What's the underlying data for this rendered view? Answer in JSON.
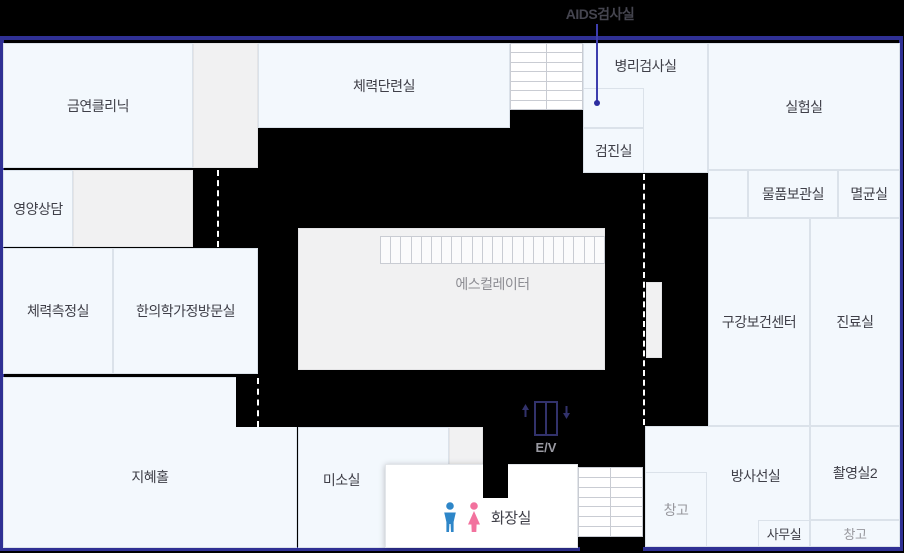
{
  "title": "health-center-floor-plan",
  "colors": {
    "background": "#000000",
    "frame": "#2f3094",
    "room_blue": "#f3f8fd",
    "room_gray": "#f1f1f2",
    "room_white": "#ffffff",
    "label_dark": "#3f3f48",
    "label_muted": "#97979d",
    "stair_line": "#c9ccd3",
    "dash": "#ffffff",
    "pointer_line": "#3e3eae",
    "male_icon": "#2e86c8",
    "female_icon": "#f2729e",
    "elevator_icon": "#32326b"
  },
  "frame": {
    "x": 0,
    "y": 36,
    "w": 903,
    "h": 515
  },
  "pointer": {
    "label": "AIDS검사실",
    "text_cx": 600,
    "text_y": 4,
    "line_x": 596,
    "line_y1": 24,
    "line_y2": 103,
    "dot_x": 594,
    "dot_y": 100
  },
  "rooms": [
    {
      "id": "geumyeon-clinic",
      "label": "금연클리닉",
      "x": 3,
      "y": 43,
      "w": 190,
      "h": 125,
      "kind": "blue"
    },
    {
      "id": "gray-room-top",
      "label": "",
      "x": 193,
      "y": 43,
      "w": 65,
      "h": 125,
      "kind": "gray"
    },
    {
      "id": "fitness-training-room",
      "label": "체력단련실",
      "x": 258,
      "y": 43,
      "w": 252,
      "h": 85,
      "kind": "blue"
    },
    {
      "id": "pathology-lab",
      "label": "병리검사실",
      "x": 583,
      "y": 43,
      "w": 125,
      "h": 130,
      "kind": "blue",
      "valign": "top",
      "pt": 12
    },
    {
      "id": "aids-test-room",
      "label": "",
      "x": 583,
      "y": 88,
      "w": 61,
      "h": 40,
      "kind": "blue"
    },
    {
      "id": "checkup-room",
      "label": "검진실",
      "x": 583,
      "y": 128,
      "w": 61,
      "h": 45,
      "kind": "blue"
    },
    {
      "id": "laboratory",
      "label": "실험실",
      "x": 708,
      "y": 43,
      "w": 192,
      "h": 127,
      "kind": "blue"
    },
    {
      "id": "blank-cell",
      "label": "",
      "x": 708,
      "y": 170,
      "w": 40,
      "h": 48,
      "kind": "blue"
    },
    {
      "id": "supply-storage-room",
      "label": "물품보관실",
      "x": 748,
      "y": 170,
      "w": 90,
      "h": 48,
      "kind": "blue"
    },
    {
      "id": "sterilization-room",
      "label": "멸균실",
      "x": 838,
      "y": 170,
      "w": 62,
      "h": 48,
      "kind": "blue"
    },
    {
      "id": "nutrition-counseling",
      "label": "영양상담",
      "x": 3,
      "y": 170,
      "w": 70,
      "h": 77,
      "kind": "blue"
    },
    {
      "id": "gray-room-left",
      "label": "",
      "x": 73,
      "y": 170,
      "w": 120,
      "h": 77,
      "kind": "gray"
    },
    {
      "id": "fitness-test-room",
      "label": "체력측정실",
      "x": 3,
      "y": 248,
      "w": 110,
      "h": 126,
      "kind": "blue"
    },
    {
      "id": "oriental-medicine-room",
      "label": "한의학가정방문실",
      "x": 113,
      "y": 248,
      "w": 145,
      "h": 126,
      "kind": "blue"
    },
    {
      "id": "escalator-room",
      "label": "",
      "x": 298,
      "y": 228,
      "w": 307,
      "h": 142,
      "kind": "gray"
    },
    {
      "id": "oral-health-center",
      "label": "구강보건센터",
      "x": 708,
      "y": 218,
      "w": 102,
      "h": 208,
      "kind": "blue"
    },
    {
      "id": "treatment-room",
      "label": "진료실",
      "x": 810,
      "y": 218,
      "w": 90,
      "h": 208,
      "kind": "blue"
    },
    {
      "id": "wisdom-hall",
      "label": "지혜홀",
      "x": 3,
      "y": 377,
      "w": 294,
      "h": 171,
      "kind": "blue",
      "dy": 14
    },
    {
      "id": "miso-room",
      "label": "미소실",
      "x": 298,
      "y": 427,
      "w": 151,
      "h": 121,
      "kind": "blue",
      "dx": -32,
      "dy": -8
    },
    {
      "id": "gray-room-small",
      "label": "",
      "x": 449,
      "y": 427,
      "w": 34,
      "h": 39,
      "kind": "gray"
    },
    {
      "id": "radiology-room",
      "label": "방사선실",
      "x": 645,
      "y": 426,
      "w": 165,
      "h": 121,
      "kind": "blue",
      "dx": 28,
      "dy": -11
    },
    {
      "id": "imaging-room-2",
      "label": "촬영실2",
      "x": 810,
      "y": 426,
      "w": 90,
      "h": 94,
      "kind": "blue"
    },
    {
      "id": "warehouse-left",
      "label": "창고",
      "x": 645,
      "y": 472,
      "w": 62,
      "h": 75,
      "kind": "blue",
      "muted": true
    },
    {
      "id": "office",
      "label": "사무실",
      "x": 758,
      "y": 520,
      "w": 52,
      "h": 27,
      "kind": "blue",
      "small": true
    },
    {
      "id": "warehouse-right",
      "label": "창고",
      "x": 810,
      "y": 520,
      "w": 90,
      "h": 27,
      "kind": "blue",
      "muted": true,
      "small": true
    },
    {
      "id": "restroom",
      "label": "",
      "x": 385,
      "y": 464,
      "w": 193,
      "h": 84,
      "kind": "white"
    },
    {
      "id": "white-strip",
      "label": "",
      "x": 646,
      "y": 282,
      "w": 16,
      "h": 76,
      "kind": "gray"
    }
  ],
  "overlays": [
    {
      "id": "corridor-notch-wisdom-hall",
      "x": 236,
      "y": 377,
      "w": 61,
      "h": 50
    },
    {
      "id": "corridor-finger-restroom",
      "x": 483,
      "y": 427,
      "w": 25,
      "h": 71
    },
    {
      "id": "border-gap-bottom",
      "x": 580,
      "y": 537,
      "w": 63,
      "h": 16
    }
  ],
  "dashed_lines": [
    {
      "id": "dash-left-corridor",
      "x": 217,
      "y": 170,
      "h": 77
    },
    {
      "id": "dash-right-corridor",
      "x": 643,
      "y": 174,
      "h": 251
    },
    {
      "id": "dash-bottom-corridor",
      "x": 257,
      "y": 378,
      "h": 49
    }
  ],
  "stairs": [
    {
      "id": "stairs-top",
      "x": 510,
      "y": 43,
      "w": 73,
      "h": 67,
      "cols": 2,
      "rows": 7
    },
    {
      "id": "stairs-bottom",
      "x": 578,
      "y": 467,
      "w": 65,
      "h": 70,
      "cols": 2,
      "rows": 7
    }
  ],
  "escalator": {
    "strip": {
      "x": 380,
      "y": 236,
      "w": 225,
      "h": 28,
      "slats": 22
    },
    "label": "에스컬레이터",
    "label_x": 380,
    "label_w": 225,
    "label_y": 274
  },
  "elevator": {
    "label": "E/V",
    "icon_x": 520,
    "icon_y": 400,
    "icon_w": 52,
    "icon_h": 38,
    "label_x": 520,
    "label_w": 52,
    "label_y": 440
  },
  "restroom_sign": {
    "label": "화장실",
    "x": 443,
    "y": 502
  }
}
